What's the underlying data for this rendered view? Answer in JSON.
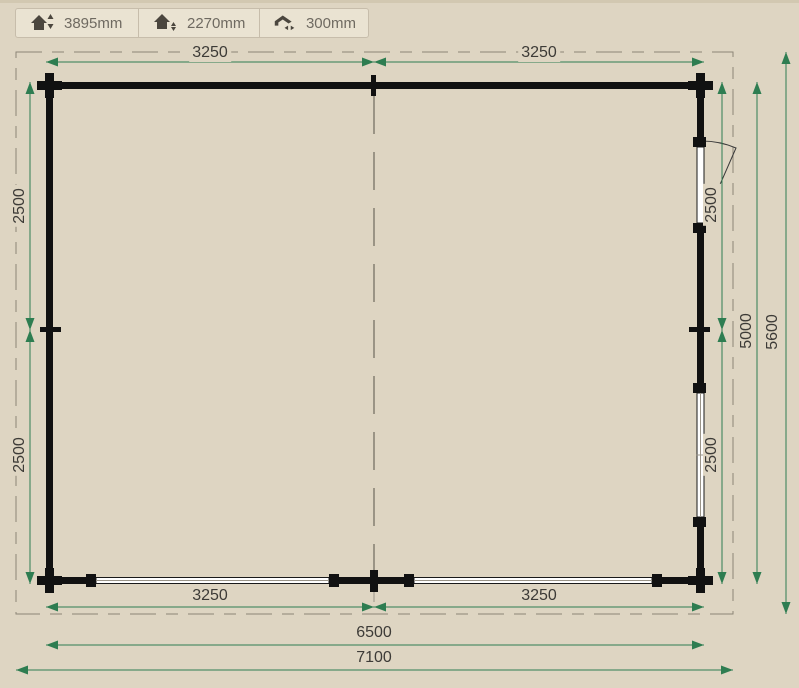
{
  "toolbar": {
    "ridge_height": {
      "icon": "ridge-height-icon",
      "value": "3895mm"
    },
    "eave_height": {
      "icon": "eave-height-icon",
      "value": "2270mm"
    },
    "roof_overhang": {
      "icon": "roof-overhang-icon",
      "value": "300mm"
    }
  },
  "plan": {
    "dimensions": {
      "top": [
        "3250",
        "3250"
      ],
      "bottom": [
        "3250",
        "3250"
      ],
      "left": [
        "2500",
        "2500"
      ],
      "right": [
        "2500",
        "2500"
      ],
      "wall_width": "6500",
      "total_width": "7100",
      "wall_depth": "5000",
      "total_depth": "5600"
    },
    "features": {
      "door": "door-right-wall",
      "windows": [
        "window-bottom-left",
        "window-bottom-right",
        "window-right-wall"
      ],
      "ridge": "center-ridge-line",
      "roof_overhang_outline": "dashed"
    }
  },
  "colors": {
    "background": "#ded5c2",
    "wall": "#111111",
    "dimension_green": "#2e7d51",
    "dimension_text": "#3d3b37",
    "dash_gray": "#8c8577"
  }
}
